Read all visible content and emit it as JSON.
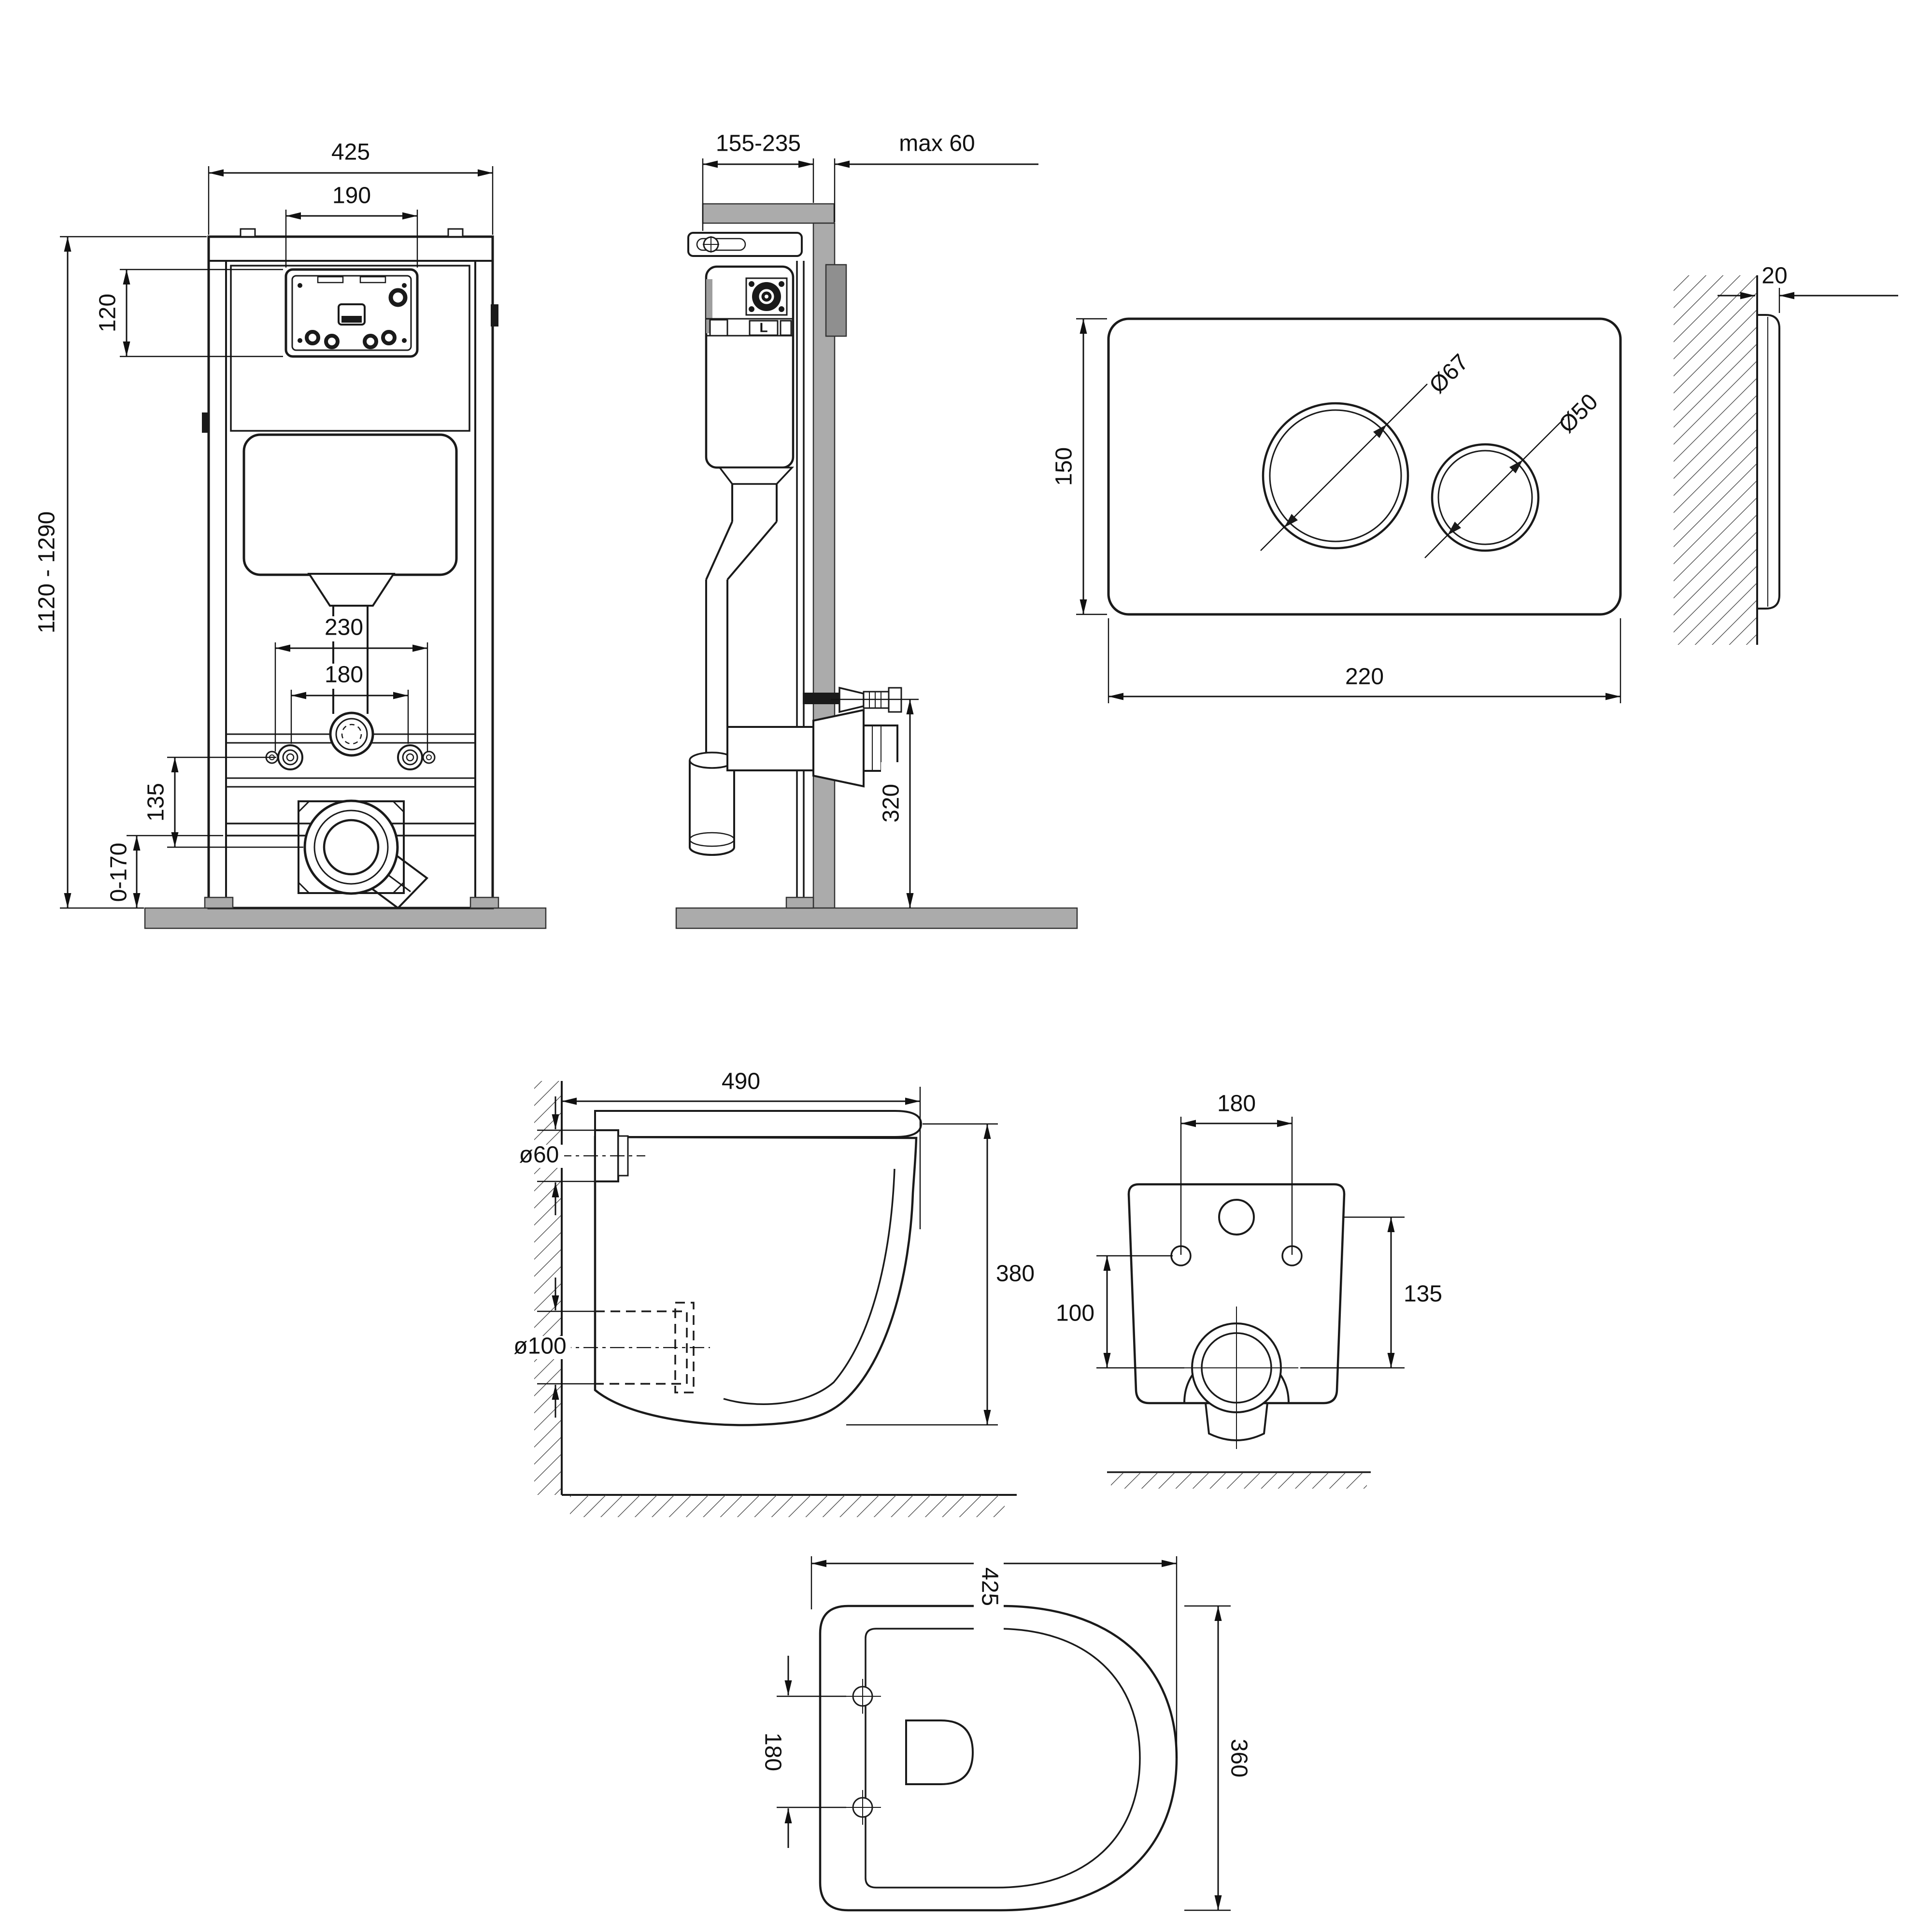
{
  "drawing": {
    "frame_front": {
      "width": "425",
      "opening_width": "190",
      "opening_height": "120",
      "height_range": "1120 - 1290",
      "anchor_span": "230",
      "bolt_span": "180",
      "bolt_to_outlet": "135",
      "base_adjust": "0-170"
    },
    "frame_side": {
      "depth_range": "155-235",
      "wall_max": "max 60",
      "outlet_height": "320",
      "valve_mark": "L"
    },
    "plate_front": {
      "height": "150",
      "width": "220",
      "big_button_dia": "Ø67",
      "small_button_dia": "Ø50"
    },
    "plate_side": {
      "thickness": "20"
    },
    "bowl_side": {
      "depth": "490",
      "inlet_dia": "ø60",
      "outlet_dia": "ø100",
      "height": "380"
    },
    "bowl_rear": {
      "bolt_span": "180",
      "bolt_to_outlet": "100",
      "hole_to_outlet": "135"
    },
    "bowl_bottom": {
      "depth": "425",
      "bolt_span": "180",
      "width": "360"
    }
  }
}
